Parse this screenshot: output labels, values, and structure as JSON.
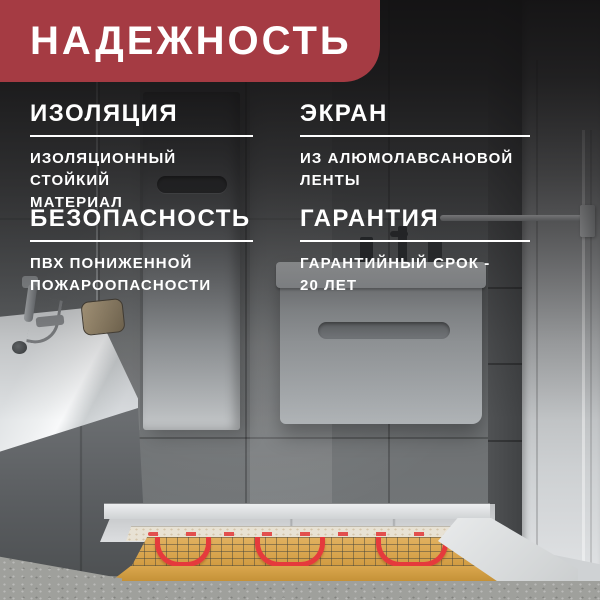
{
  "banner": {
    "title": "НАДЕЖНОСТЬ",
    "bg_color": "#a53b43",
    "text_color": "#ffffff"
  },
  "features": [
    {
      "title": "ИЗОЛЯЦИЯ",
      "lines": [
        "ИЗОЛЯЦИОННЫЙ СТОЙКИЙ",
        "МАТЕРИАЛ"
      ]
    },
    {
      "title": "ЭКРАН",
      "lines": [
        "ИЗ АЛЮМОЛАВСАНОВОЙ",
        "ЛЕНТЫ"
      ]
    },
    {
      "title": "БЕЗОПАСНОСТЬ",
      "lines": [
        "ПВХ ПОНИЖЕННОЙ",
        "ПОЖАРООПАСНОСТИ"
      ]
    },
    {
      "title": "ГАРАНТИЯ",
      "lines": [
        "ГАРАНТИЙНЫЙ СРОК -",
        "20 ЛЕТ"
      ]
    }
  ],
  "scene": {
    "name": "bathroom-with-underfloor-heating-mat",
    "elements": [
      "bathtub",
      "shower-mixer",
      "glass-screen",
      "tall-cabinet",
      "vanity-cabinet",
      "towel-bar",
      "door",
      "tiled-floor",
      "heating-mat",
      "red-heating-cable",
      "concrete-screed"
    ],
    "colors": {
      "banner_red": "#a53b43",
      "mat_tan": "#dcab55",
      "cable_red": "#e53a3c",
      "wall_gray": "#606365",
      "floor_gray": "#d5d7d9",
      "concrete_gray": "#9fa09c",
      "furniture_white": "#e9ebec"
    }
  }
}
